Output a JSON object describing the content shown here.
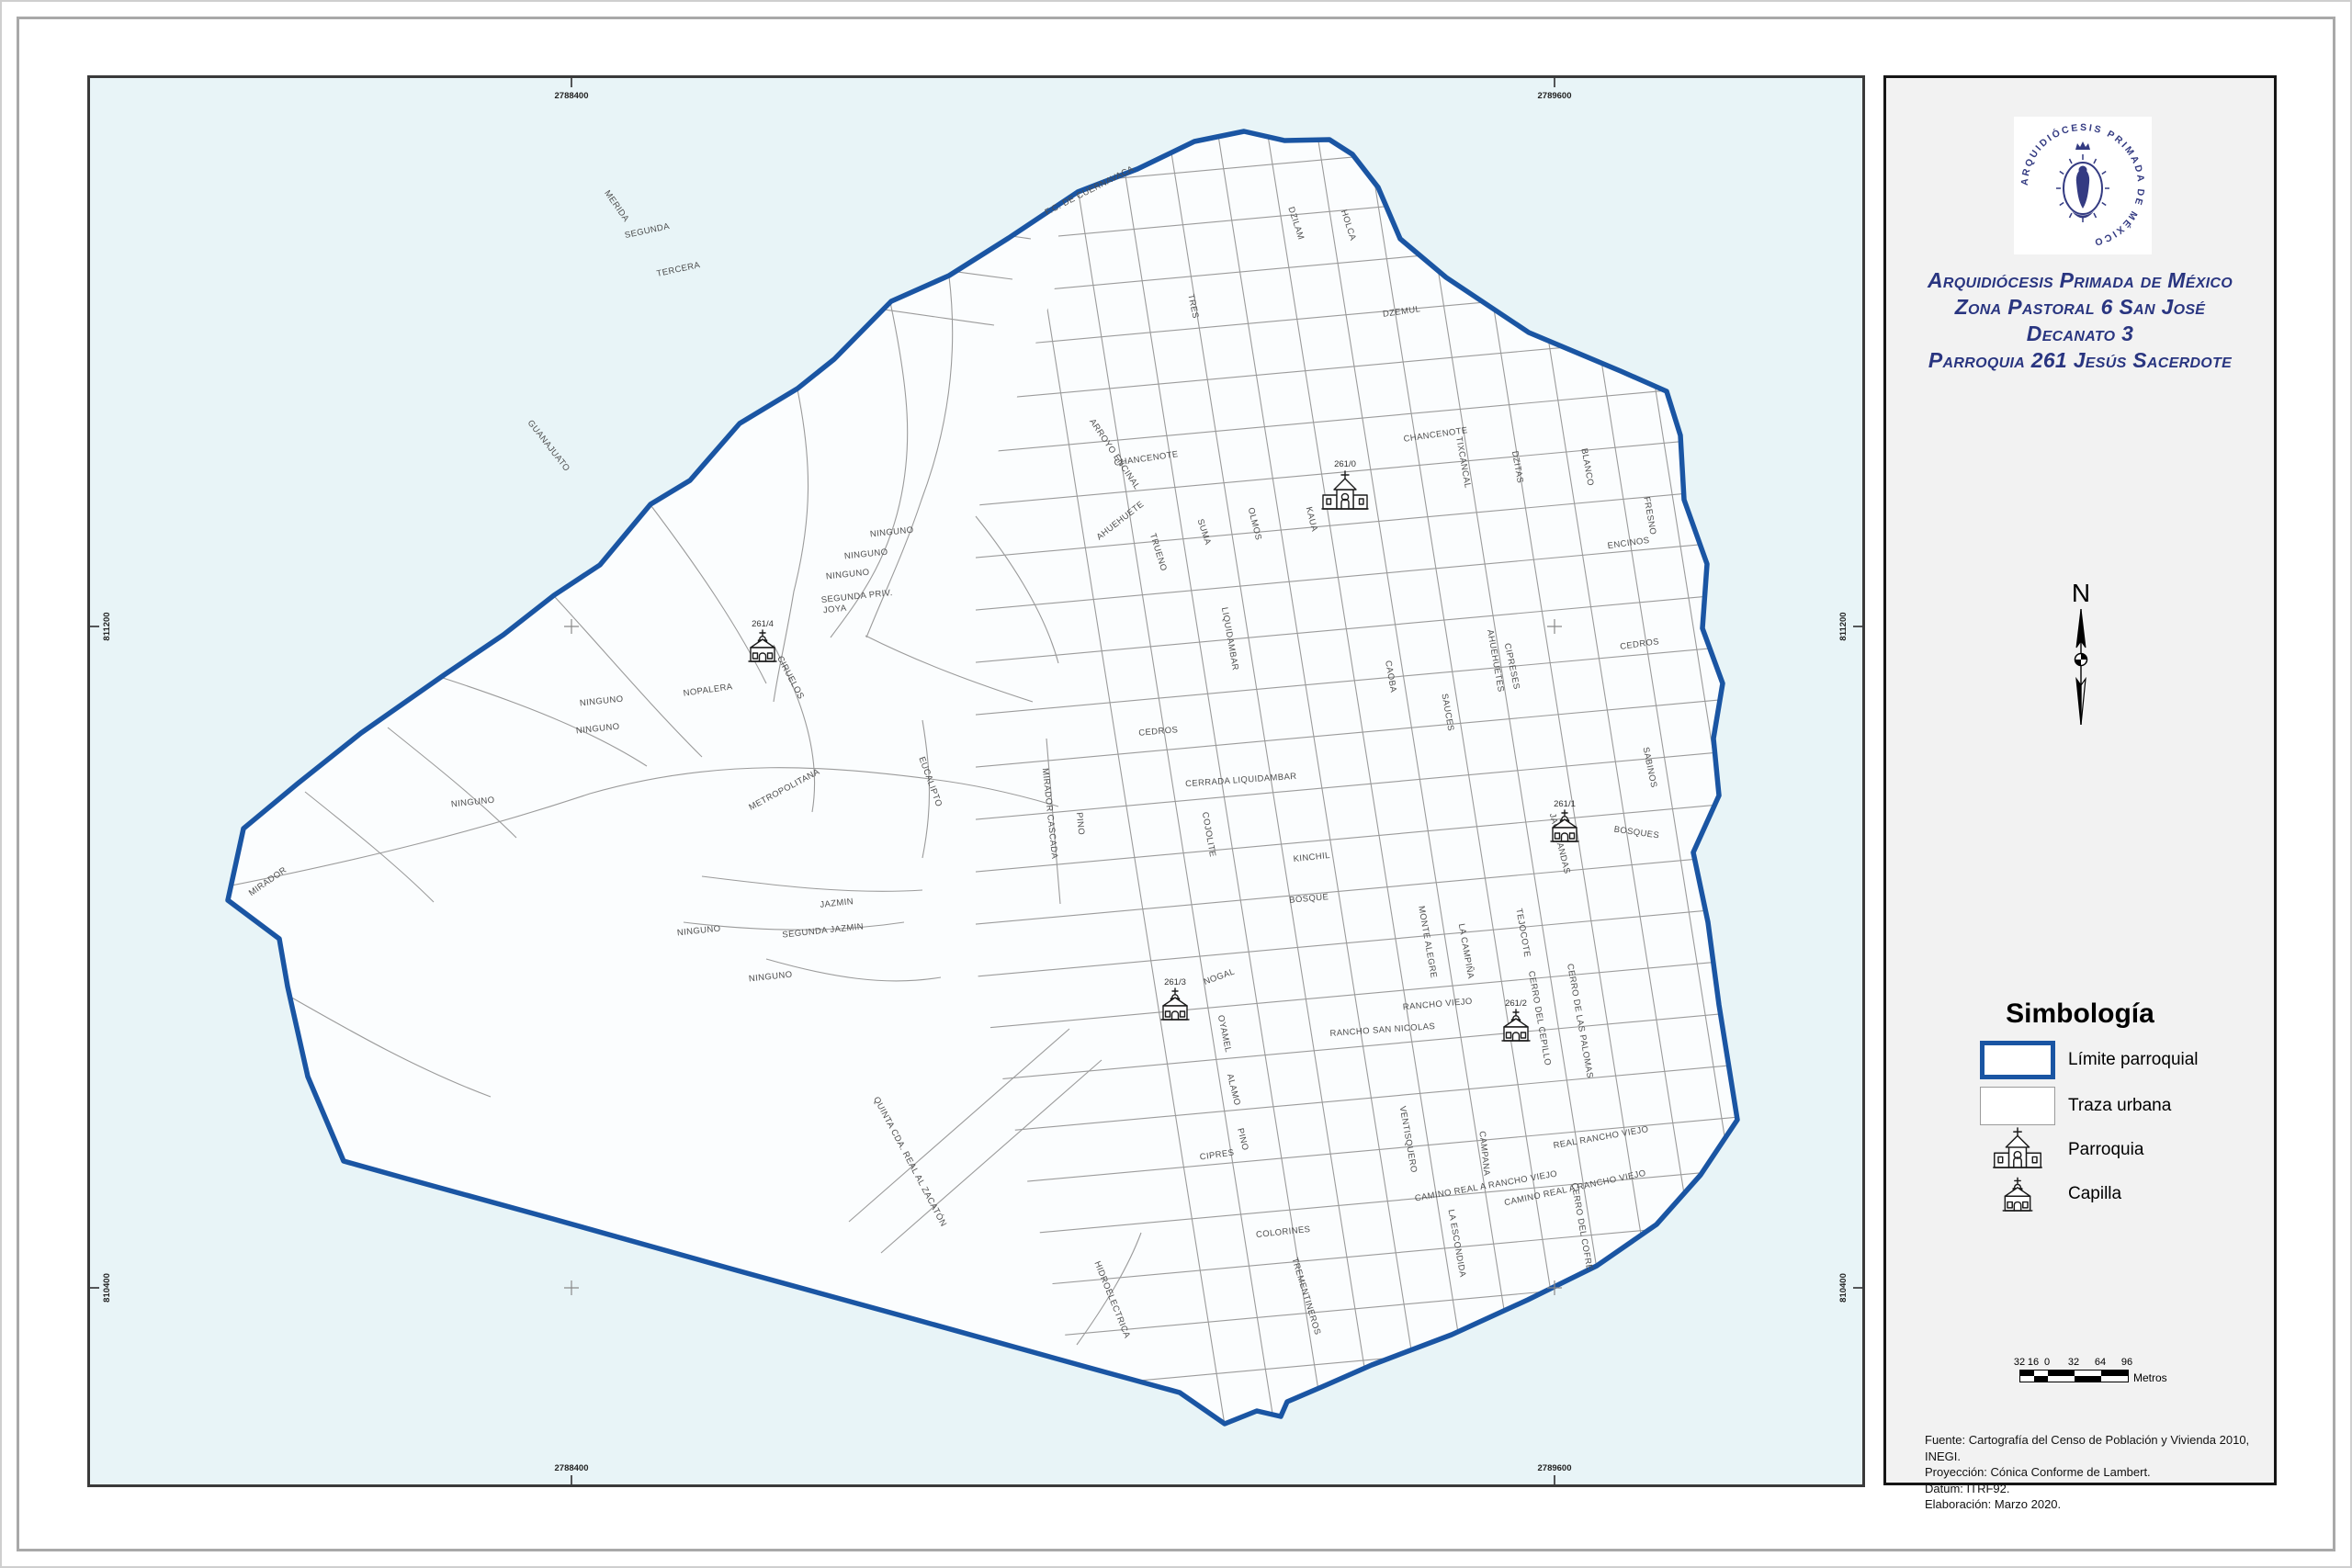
{
  "panel": {
    "seal_text": "ARQUIDIÓCESIS PRIMADA DE MÉXICO",
    "title_lines": [
      "Arquidiócesis Primada de México",
      "Zona Pastoral 6 San José",
      "Decanato 3",
      "Parroquia 261 Jesús Sacerdote"
    ],
    "north_label": "N",
    "legend": {
      "heading": "Simbología",
      "items": [
        {
          "symbol": "limite-parroquial-swatch",
          "label": "Límite parroquial"
        },
        {
          "symbol": "traza-urbana-swatch",
          "label": "Traza urbana"
        },
        {
          "symbol": "parroquia-icon",
          "label": "Parroquia"
        },
        {
          "symbol": "capilla-icon",
          "label": "Capilla"
        }
      ]
    },
    "scalebar": {
      "ticks": [
        "32",
        "16",
        "0",
        "32",
        "64",
        "96"
      ],
      "unit": "Metros"
    },
    "credits": [
      "Fuente: Cartografía del Censo de Población y Vivienda 2010, INEGI.",
      "Proyección: Cónica Conforme de Lambert.",
      "Datum: ITRF92.",
      "Elaboración: Marzo 2020."
    ]
  },
  "map": {
    "colors": {
      "boundary": "#1a55a3",
      "background": "#e8f4f7",
      "urban_fill": "#fbfdfe",
      "street": "#9b9b9b"
    },
    "x_ticks": [
      [
        "2788400",
        620
      ],
      [
        "2789600",
        1690
      ]
    ],
    "y_ticks": [
      [
        "811200",
        680
      ],
      [
        "810400",
        1400
      ]
    ],
    "churches": [
      [
        "261/0",
        "parroquia",
        1462,
        552
      ],
      [
        "261/4",
        "capilla",
        828,
        718
      ],
      [
        "261/1",
        "capilla",
        1701,
        914
      ],
      [
        "261/3",
        "capilla",
        1277,
        1108
      ],
      [
        "261/2",
        "capilla",
        1648,
        1131
      ]
    ],
    "street_labels": [
      [
        "F.C. DE CUERNAVACA",
        1185,
        208,
        -27
      ],
      [
        "SEGUNDA",
        703,
        252,
        -12
      ],
      [
        "TERCERA",
        737,
        294,
        -12
      ],
      [
        "MERIDA",
        667,
        224,
        55
      ],
      [
        "TRES",
        1294,
        332,
        78
      ],
      [
        "DZILAM",
        1406,
        242,
        72
      ],
      [
        "HOLCA",
        1463,
        244,
        72
      ],
      [
        "DZEMUL",
        1524,
        340,
        -8
      ],
      [
        "CHANCENOTE",
        1246,
        500,
        -8
      ],
      [
        "CHANCENOTE",
        1561,
        474,
        -8
      ],
      [
        "TIXCANCAL",
        1588,
        502,
        80
      ],
      [
        "DZITAS",
        1647,
        507,
        80
      ],
      [
        "BLANCO",
        1723,
        507,
        80
      ],
      [
        "FRESNO",
        1791,
        560,
        80
      ],
      [
        "ENCINOS",
        1771,
        592,
        -8
      ],
      [
        "CEDROS",
        1783,
        702,
        -8
      ],
      [
        "CEDROS",
        1259,
        797,
        -5
      ],
      [
        "CIPRESES",
        1641,
        724,
        78
      ],
      [
        "SABINOS",
        1791,
        834,
        78
      ],
      [
        "JACARANDAS",
        1693,
        917,
        76
      ],
      [
        "BOSQUES",
        1779,
        907,
        8
      ],
      [
        "OLMOS",
        1361,
        569,
        76
      ],
      [
        "KAUA",
        1423,
        564,
        76
      ],
      [
        "SUMA",
        1306,
        578,
        72
      ],
      [
        "TRUENO",
        1256,
        600,
        73
      ],
      [
        "AHUEHUETE",
        1219,
        567,
        -38
      ],
      [
        "ARROYO ENCINAL",
        1209,
        494,
        56
      ],
      [
        "LIQUIDAMBAR",
        1334,
        694,
        80
      ],
      [
        "CAOBA",
        1509,
        735,
        80
      ],
      [
        "AHUEHUETES",
        1623,
        718,
        80
      ],
      [
        "SAUCES",
        1571,
        774,
        80
      ],
      [
        "CERRADA LIQUIDAMBAR",
        1349,
        850,
        -4
      ],
      [
        "COJOLITE",
        1311,
        907,
        80
      ],
      [
        "KINCHIL",
        1426,
        934,
        -6
      ],
      [
        "MIRADOR CASCADA",
        1138,
        884,
        84
      ],
      [
        "PINO",
        1171,
        895,
        84
      ],
      [
        "EUCALIPTO",
        1008,
        850,
        70
      ],
      [
        "METROPOLITANA",
        853,
        860,
        -28
      ],
      [
        "NINGUNO",
        969,
        580,
        -6
      ],
      [
        "NINGUNO",
        941,
        604,
        -6
      ],
      [
        "NINGUNO",
        921,
        626,
        -6
      ],
      [
        "SEGUNDA PRIV.",
        931,
        650,
        -6
      ],
      [
        "JOYA",
        907,
        664,
        -6
      ],
      [
        "NINGUNO",
        653,
        764,
        -6
      ],
      [
        "NINGUNO",
        649,
        794,
        -6
      ],
      [
        "NOPALERA",
        769,
        752,
        -8
      ],
      [
        "CIRUELOS",
        856,
        737,
        62
      ],
      [
        "NINGUNO",
        513,
        874,
        -6
      ],
      [
        "NINGUNO",
        837,
        1064,
        -6
      ],
      [
        "JAZMIN",
        909,
        984,
        -6
      ],
      [
        "SEGUNDA JAZMIN",
        894,
        1014,
        -6
      ],
      [
        "NINGUNO",
        759,
        1014,
        -6
      ],
      [
        "GUANAJUATO",
        593,
        485,
        52
      ],
      [
        "BOSQUE",
        1423,
        979,
        -5
      ],
      [
        "MONTE ALEGRE",
        1549,
        1024,
        80
      ],
      [
        "LA CAMPIÑA",
        1591,
        1034,
        80
      ],
      [
        "TEJOCOTE",
        1653,
        1014,
        80
      ],
      [
        "RANCHO VIEJO",
        1563,
        1094,
        -5
      ],
      [
        "RANCHO SAN NICOLAS",
        1503,
        1122,
        -4
      ],
      [
        "NOGAL",
        1326,
        1064,
        -20
      ],
      [
        "OYAMEL",
        1328,
        1124,
        78
      ],
      [
        "ALAMO",
        1338,
        1185,
        76
      ],
      [
        "PINO",
        1348,
        1239,
        76
      ],
      [
        "VENTISQUERO",
        1528,
        1239,
        80
      ],
      [
        "CERRO DEL CEPILLO",
        1671,
        1107,
        80
      ],
      [
        "CERRO DE LAS PALOMAS",
        1715,
        1110,
        80
      ],
      [
        "CERRO DEL COFRE",
        1717,
        1334,
        80
      ],
      [
        "CAMPANA",
        1611,
        1254,
        84
      ],
      [
        "CAMINO REAL A RANCHO VIEJO",
        1616,
        1292,
        -10
      ],
      [
        "CAMINO REAL A RANCHO VIEJO",
        1713,
        1294,
        -12
      ],
      [
        "REAL RANCHO VIEJO",
        1741,
        1239,
        -10
      ],
      [
        "LA ESCONDIDA",
        1581,
        1352,
        80
      ],
      [
        "CIPRES",
        1323,
        1258,
        -8
      ],
      [
        "COLORINES",
        1395,
        1342,
        -6
      ],
      [
        "TREMENTINEROS",
        1417,
        1410,
        73
      ],
      [
        "HIDROELECTRICA",
        1206,
        1414,
        68
      ],
      [
        "QUINTA CDA. REAL AL ZACATÓN",
        986,
        1264,
        62
      ],
      [
        "MIRADOR",
        291,
        960,
        -35
      ]
    ]
  }
}
